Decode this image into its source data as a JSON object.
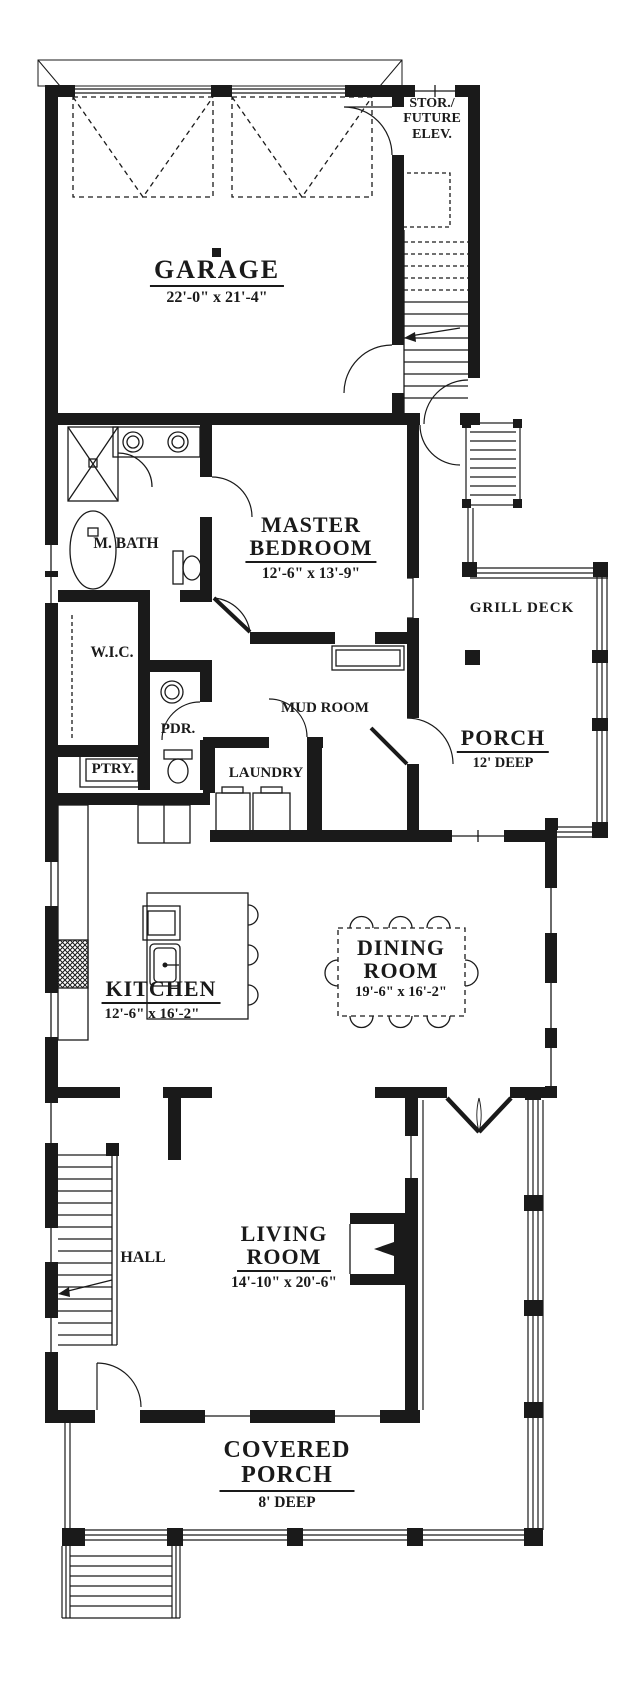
{
  "rooms": {
    "garage": {
      "name": "GARAGE",
      "dim": "22'-0\" x 21'-4\""
    },
    "storage": {
      "line1": "STOR./",
      "line2": "FUTURE",
      "line3": "ELEV."
    },
    "master_bath": {
      "name": "M. BATH"
    },
    "master_bedroom": {
      "line1": "MASTER",
      "line2": "BEDROOM",
      "dim": "12'-6\" x 13'-9\""
    },
    "closet": {
      "name": "W.I.C."
    },
    "mud_room": {
      "name": "MUD ROOM"
    },
    "powder": {
      "name": "PDR."
    },
    "pantry": {
      "name": "PTRY."
    },
    "laundry": {
      "name": "LAUNDRY"
    },
    "grill_deck": {
      "name": "GRILL DECK"
    },
    "porch": {
      "name": "PORCH",
      "dim": "12'  DEEP"
    },
    "kitchen": {
      "name": "KITCHEN",
      "dim": "12'-6\" x 16'-2\""
    },
    "dining": {
      "line1": "DINING",
      "line2": "ROOM",
      "dim": "19'-6\" x 16'-2\""
    },
    "hall": {
      "name": "HALL"
    },
    "living": {
      "line1": "LIVING",
      "line2": "ROOM",
      "dim": "14'-10\" x 20'-6\""
    },
    "covered_porch": {
      "line1": "COVERED",
      "line2": "PORCH",
      "dim": "8'  DEEP"
    }
  },
  "colors": {
    "ink": "#1a1a1a",
    "paper": "#ffffff"
  }
}
